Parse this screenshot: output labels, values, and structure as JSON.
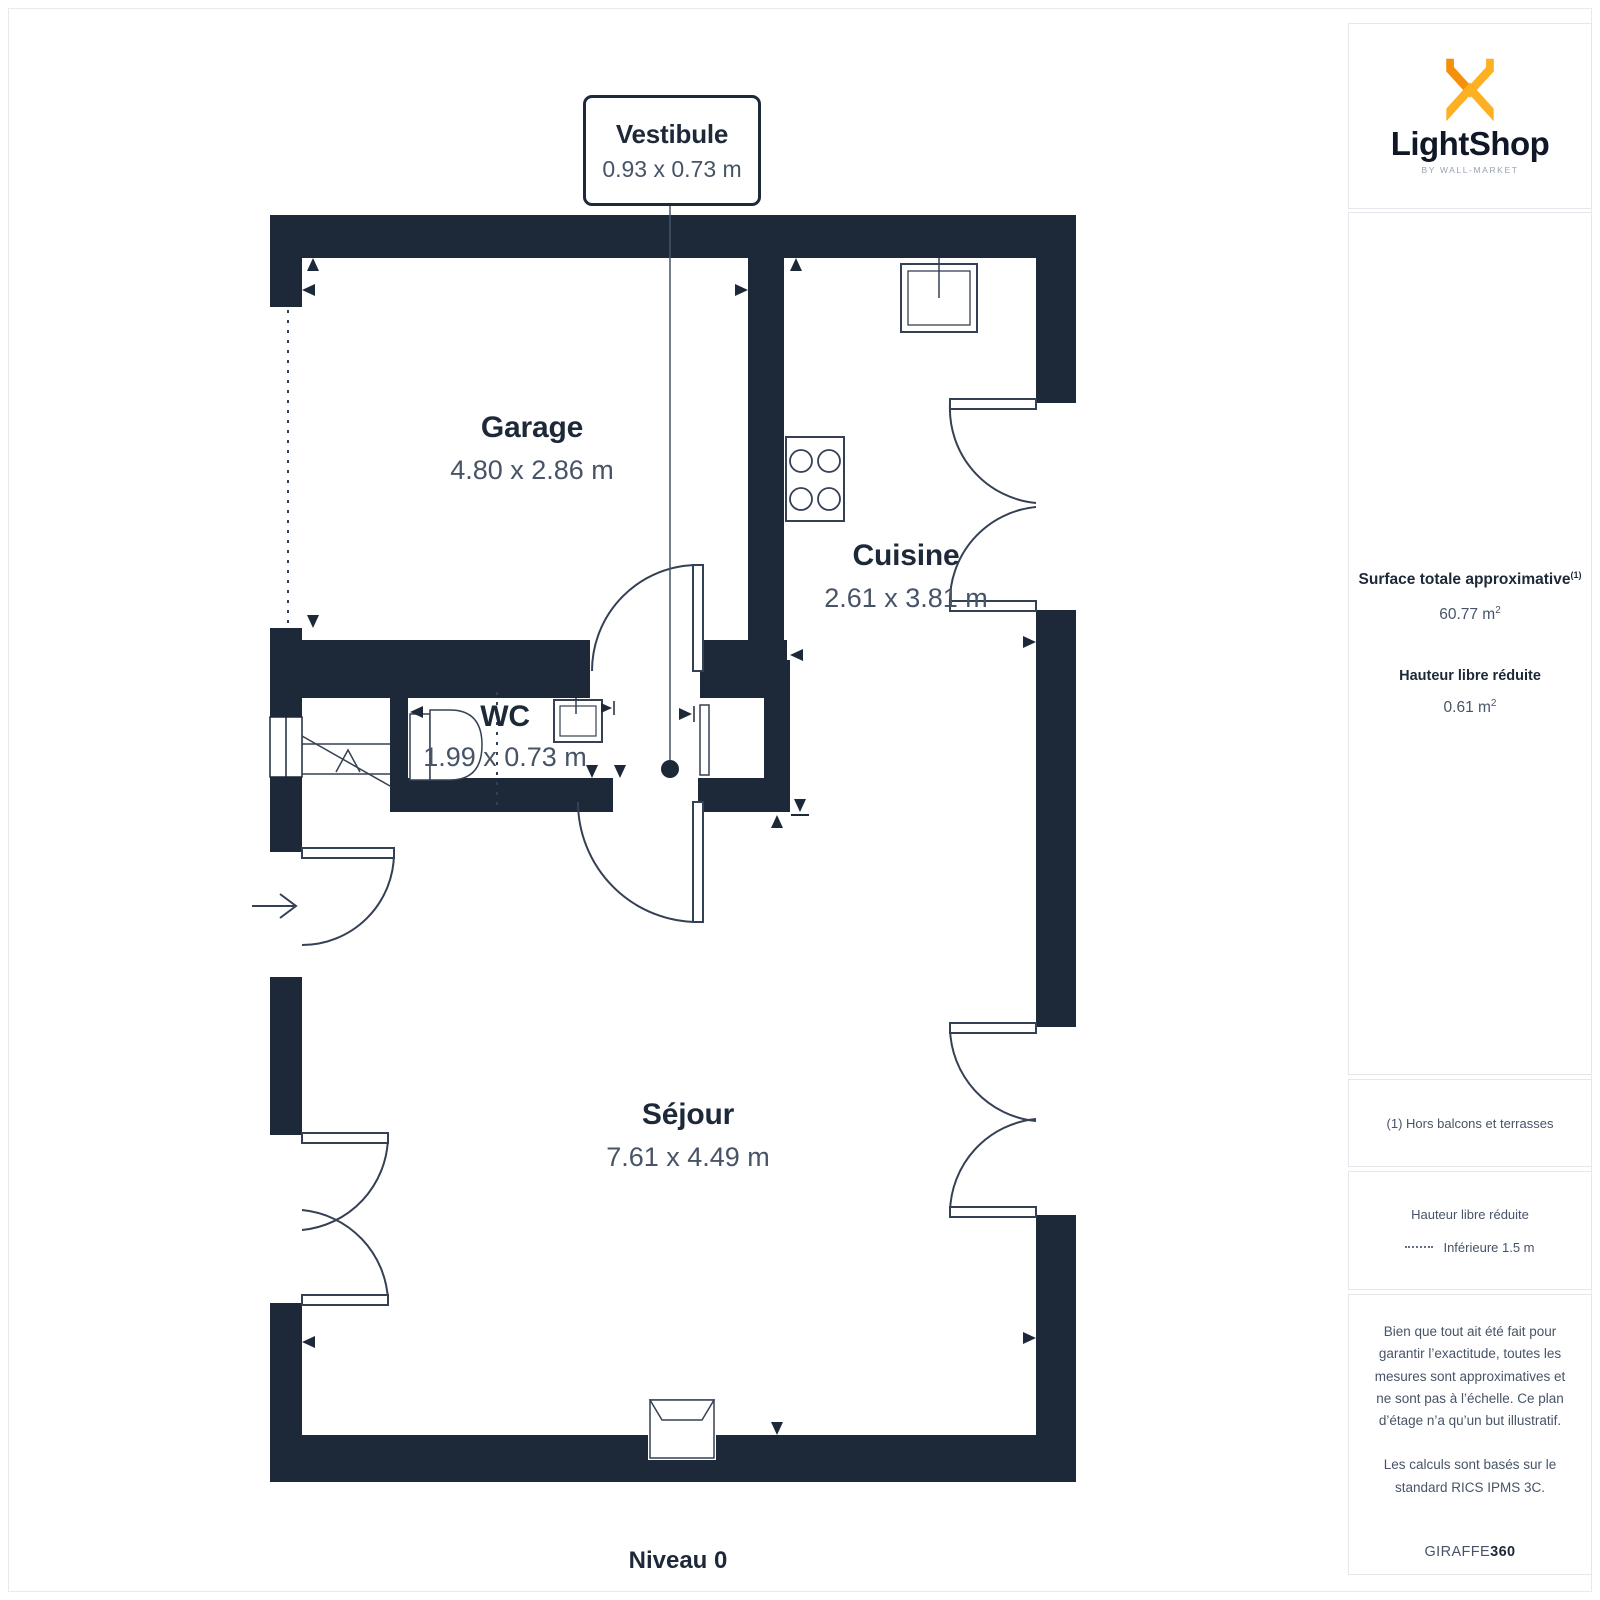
{
  "plan": {
    "level_label": "Niveau 0",
    "rooms": {
      "vestibule": {
        "name": "Vestibule",
        "dims": "0.93 x 0.73 m"
      },
      "garage": {
        "name": "Garage",
        "dims": "4.80 x 2.86 m"
      },
      "cuisine": {
        "name": "Cuisine",
        "dims": "2.61 x 3.81 m"
      },
      "wc": {
        "name": "WC",
        "dims": "1.99 x 0.73 m"
      },
      "sejour": {
        "name": "Séjour",
        "dims": "7.61 x 4.49 m"
      }
    }
  },
  "sidebar": {
    "logo": {
      "brand": "LightShop",
      "tagline": "BY WALL-MARKET"
    },
    "summary": {
      "surface_label": "Surface totale approximative",
      "surface_sup": "(1)",
      "surface_value": "60.77 m",
      "surface_value_sup": "2",
      "reduced_label": "Hauteur libre réduite",
      "reduced_value": "0.61 m",
      "reduced_value_sup": "2"
    },
    "footnote": "(1) Hors balcons et terrasses",
    "legend": {
      "title": "Hauteur libre réduite",
      "item": "Inférieure 1.5 m"
    },
    "disclaimer_1": "Bien que tout ait été fait pour garantir l’exactitude, toutes les mesures sont approximatives et ne sont pas à l’échelle. Ce plan d’étage n’a qu’un but illustratif.",
    "disclaimer_2": "Les calculs sont basés sur le standard RICS IPMS 3C.",
    "brand_footer": {
      "giraffe": "GIRAFFE",
      "suffix": "360"
    }
  },
  "colors": {
    "wall": "#1d2939",
    "dims_text": "#475467",
    "logo_orange": "#F79009",
    "logo_yellow": "#FDB022",
    "box_border": "#e4e7ec"
  }
}
